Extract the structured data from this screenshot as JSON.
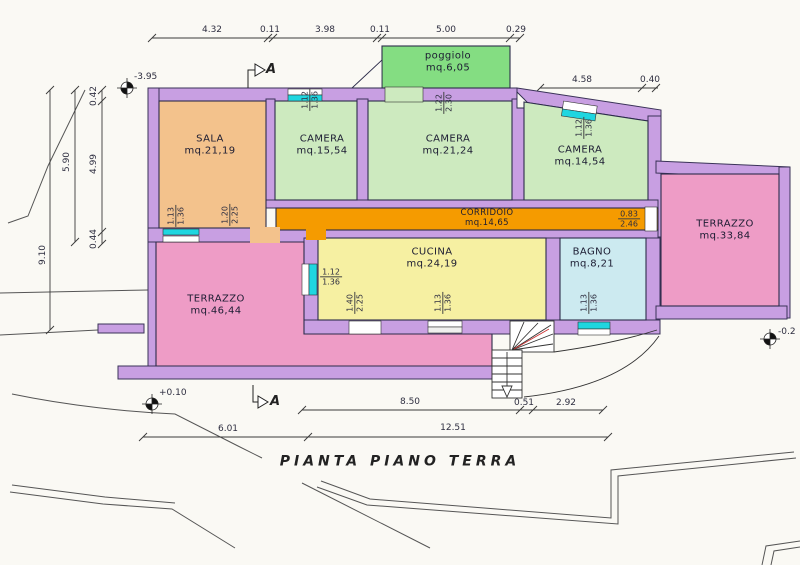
{
  "title": "PIANTA PIANO TERRA",
  "rooms": {
    "sala": {
      "name": "SALA",
      "area": "mq.21,19"
    },
    "camera1": {
      "name": "CAMERA",
      "area": "mq.15,54"
    },
    "camera2": {
      "name": "CAMERA",
      "area": "mq.21,24"
    },
    "camera3": {
      "name": "CAMERA",
      "area": "mq.14,54"
    },
    "poggiolo": {
      "name": "poggiolo",
      "area": "mq.6,05"
    },
    "corridoio": {
      "name": "CORRIDOIO",
      "area": "mq.14,65"
    },
    "cucina": {
      "name": "CUCINA",
      "area": "mq.24,19"
    },
    "bagno": {
      "name": "BAGNO",
      "area": "mq.8,21"
    },
    "terrazzo_ovest": {
      "name": "TERRAZZO",
      "area": "mq.46,44"
    },
    "terrazzo_est": {
      "name": "TERRAZZO",
      "area": "mq.33,84"
    }
  },
  "dimensions": {
    "top": [
      "4.32",
      "0.11",
      "3.98",
      "0.11",
      "5.00",
      "0.29"
    ],
    "top_right": [
      "4.58",
      "0.40"
    ],
    "left": [
      "9.10",
      "5.90",
      "0.42",
      "4.99",
      "0.44"
    ],
    "bottom_upper": [
      "8.50",
      "0.51",
      "2.92"
    ],
    "bottom_lower": [
      "6.01",
      "12.51"
    ]
  },
  "openings": {
    "sala_window": {
      "w": "1.13",
      "h": "1.36"
    },
    "sala_door": {
      "w": "1.20",
      "h": "2.25"
    },
    "camera1_window": {
      "w": "1.12",
      "h": "1.36"
    },
    "camera2_door": {
      "w": "1.22",
      "h": "2.30"
    },
    "camera3_window": {
      "w": "1.12",
      "h": "1.36"
    },
    "corridoio_end": {
      "w": "0.83",
      "h": "2.46"
    },
    "cucina_window_left": {
      "w": "1.12",
      "h": "1.36"
    },
    "cucina_door": {
      "w": "1.40",
      "h": "2.25"
    },
    "cucina_window_bottom": {
      "w": "1.13",
      "h": "1.36"
    },
    "bagno_window": {
      "w": "1.13",
      "h": "1.36"
    }
  },
  "levels": {
    "top_left": "-3.95",
    "bottom_left": "+0.10",
    "right": "-0.2"
  },
  "section": {
    "label": "A"
  },
  "colors": {
    "wall": "#c89fe2",
    "sala": "#f3c28c",
    "camera": "#cdeabf",
    "poggiolo": "#84dd82",
    "corridoio": "#f59b00",
    "cucina": "#f6f0a2",
    "bagno": "#cceaf0",
    "terrazzo": "#ee9cc6",
    "window": "#1fd6e0",
    "stair_mark": "#cc3333",
    "paper": "#faf9f4",
    "line": "#3a3a3a"
  }
}
